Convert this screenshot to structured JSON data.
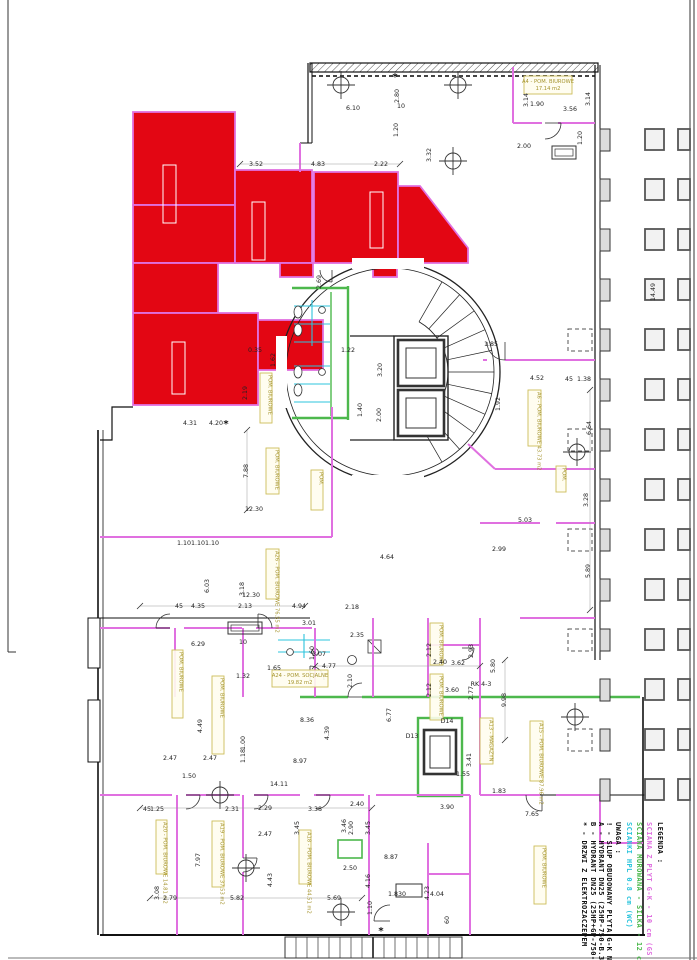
{
  "legend": {
    "title": "LEGENDA :",
    "items": [
      {
        "color": "#e070e0",
        "label": "SCIANA Z PLYT G-K - 10 cm (GS 100)"
      },
      {
        "color": "#4db84d",
        "label": "SCIANA MUROWANA - SILKA - 12 cm"
      },
      {
        "color": "#2cc4dc",
        "label": "SCIANKI HPL 0.8 cm (WC)"
      }
    ]
  },
  "notes": {
    "title": "UWAGA :",
    "items": [
      "! - SLUP OBUDOWANY PLYTA G-K NA STEL.",
      "A - HYDRANT DN25 (25HP-750-B.30: 25 X",
      "B - HYDRANT DN25 (25HP+GP-750-B.30 ) 2",
      "* - DRZWI Z ELEKTROZACZEPEM"
    ]
  },
  "rooms": [
    {
      "l": "A4 - POM. BIUROWE",
      "a": "17.14 m2",
      "x": 524,
      "y": 76,
      "w": 48,
      "h": 18,
      "v": 0
    },
    {
      "l": "A24 - POM. SOCJALNE",
      "a": "19.82 m2",
      "x": 272,
      "y": 670,
      "w": 56,
      "h": 17,
      "v": 0
    },
    {
      "l": "A6 - POM. BIUROWE",
      "a": "43.73 m2",
      "x": 528,
      "y": 390,
      "w": 13,
      "h": 56,
      "v": 1
    },
    {
      "l": "A26 - POM. BIUROWE",
      "a": "76.55 m2",
      "x": 266,
      "y": 549,
      "w": 13,
      "h": 50,
      "v": 1
    },
    {
      "l": "POM. BIUROWE",
      "a": "",
      "x": 172,
      "y": 650,
      "w": 11,
      "h": 68,
      "v": 1
    },
    {
      "l": "POM. BIUROWE",
      "a": "",
      "x": 212,
      "y": 676,
      "w": 12,
      "h": 78,
      "v": 1
    },
    {
      "l": "A19 - POM. BIUROWE",
      "a": "37.53 m2",
      "x": 212,
      "y": 821,
      "w": 12,
      "h": 66,
      "v": 1
    },
    {
      "l": "A20 - POM. BIUROWE",
      "a": "14.81 m2",
      "x": 156,
      "y": 820,
      "w": 11,
      "h": 54,
      "v": 1
    },
    {
      "l": "A18 - POM. BIUROWE",
      "a": "44.51 m2",
      "x": 299,
      "y": 830,
      "w": 12,
      "h": 54,
      "v": 1
    },
    {
      "l": "POM. BIUROWE",
      "a": "",
      "x": 534,
      "y": 846,
      "w": 12,
      "h": 58,
      "v": 1
    },
    {
      "l": "A15 - POM. BIUROWE",
      "a": "87.96 m2",
      "x": 530,
      "y": 721,
      "w": 13,
      "h": 60,
      "v": 1
    },
    {
      "l": "A13 - MAGAZYN",
      "a": "",
      "x": 480,
      "y": 718,
      "w": 13,
      "h": 46,
      "v": 1
    },
    {
      "l": "POM. BIUROWE",
      "a": "",
      "x": 430,
      "y": 623,
      "w": 13,
      "h": 42,
      "v": 1
    },
    {
      "l": "POM. BIUROWE",
      "a": "",
      "x": 430,
      "y": 674,
      "w": 13,
      "h": 46,
      "v": 1
    },
    {
      "l": "POM. BIUROWE",
      "a": "",
      "x": 266,
      "y": 448,
      "w": 13,
      "h": 46,
      "v": 1
    },
    {
      "l": "POM.",
      "a": "",
      "x": 311,
      "y": 470,
      "w": 12,
      "h": 40,
      "v": 1
    },
    {
      "l": "POM. BIUROWE",
      "a": "",
      "x": 260,
      "y": 373,
      "w": 12,
      "h": 50,
      "v": 1
    },
    {
      "l": "POM.",
      "a": "",
      "x": 556,
      "y": 466,
      "w": 10,
      "h": 26,
      "v": 1
    }
  ],
  "dimensions": [
    [
      "3.52",
      256,
      166,
      0
    ],
    [
      "4.83",
      318,
      166,
      0
    ],
    [
      "2.22",
      381,
      166,
      0
    ],
    [
      "6.10",
      353,
      110,
      0
    ],
    [
      "2.80",
      399,
      96,
      1
    ],
    [
      "1.20",
      398,
      130,
      1
    ],
    [
      "3.32",
      431,
      155,
      1
    ],
    [
      "1.90",
      537,
      106,
      0
    ],
    [
      "3.56",
      570,
      111,
      0
    ],
    [
      "3.14",
      528,
      100,
      1
    ],
    [
      "3.14",
      590,
      99,
      1
    ],
    [
      "2.00",
      524,
      148,
      0
    ],
    [
      "1.20",
      582,
      138,
      1
    ],
    [
      "14.49",
      655,
      292,
      1
    ],
    [
      "6.64",
      591,
      428,
      1
    ],
    [
      "3.28",
      588,
      500,
      1
    ],
    [
      "5.89",
      590,
      571,
      1
    ],
    [
      "4.52",
      537,
      380,
      0
    ],
    [
      "45",
      569,
      381,
      0
    ],
    [
      "1.38",
      584,
      381,
      0
    ],
    [
      "1.85",
      491,
      346,
      0
    ],
    [
      "1.92",
      500,
      404,
      1
    ],
    [
      "7.88",
      248,
      471,
      1
    ],
    [
      "12.30",
      254,
      511,
      0
    ],
    [
      "12.30",
      251,
      597,
      0
    ],
    [
      "6.03",
      209,
      586,
      1
    ],
    [
      "3.18",
      244,
      589,
      1
    ],
    [
      "45",
      179,
      608,
      0
    ],
    [
      "4.35",
      198,
      608,
      0
    ],
    [
      "2.13",
      245,
      608,
      0
    ],
    [
      "4.94",
      299,
      608,
      0
    ],
    [
      "1.10",
      184,
      545,
      0
    ],
    [
      "1.10",
      198,
      545,
      0
    ],
    [
      "1.10",
      212,
      545,
      0
    ],
    [
      "4.31",
      190,
      425,
      0
    ],
    [
      "4.20",
      216,
      425,
      0
    ],
    [
      "2.19",
      247,
      393,
      1
    ],
    [
      "1.62",
      275,
      360,
      1
    ],
    [
      "0.35",
      255,
      352,
      0
    ],
    [
      "2.69",
      321,
      282,
      1
    ],
    [
      "1.22",
      348,
      352,
      0
    ],
    [
      "3.20",
      382,
      370,
      1
    ],
    [
      "2.00",
      381,
      415,
      1
    ],
    [
      "1.40",
      362,
      410,
      1
    ],
    [
      "6.29",
      198,
      646,
      0
    ],
    [
      "1.32",
      243,
      678,
      0
    ],
    [
      "1.65",
      274,
      670,
      0
    ],
    [
      "4.77",
      329,
      668,
      0
    ],
    [
      "2.35",
      357,
      637,
      0
    ],
    [
      "2.10",
      352,
      681,
      1
    ],
    [
      "8.36",
      307,
      722,
      0
    ],
    [
      "4.39",
      329,
      733,
      1
    ],
    [
      "8.97",
      300,
      763,
      0
    ],
    [
      "14.11",
      279,
      786,
      0
    ],
    [
      "2.47",
      170,
      760,
      0
    ],
    [
      "2.47",
      210,
      760,
      0
    ],
    [
      "1.50",
      189,
      778,
      0
    ],
    [
      "4.49",
      202,
      726,
      1
    ],
    [
      "1.00",
      245,
      743,
      1
    ],
    [
      "1.18",
      245,
      756,
      1
    ],
    [
      "3.01",
      309,
      625,
      0
    ],
    [
      "1.60",
      314,
      653,
      1
    ],
    [
      "3.07",
      319,
      656,
      0
    ],
    [
      "6.77",
      391,
      715,
      1
    ],
    [
      "2.12",
      431,
      650,
      1
    ],
    [
      "2.93",
      473,
      651,
      1
    ],
    [
      "3.62",
      458,
      665,
      0
    ],
    [
      "5.80",
      495,
      666,
      1
    ],
    [
      "9.98",
      506,
      700,
      1
    ],
    [
      "2.12",
      431,
      690,
      1
    ],
    [
      "2.77",
      473,
      693,
      1
    ],
    [
      "2.40",
      440,
      664,
      0
    ],
    [
      "3.60",
      452,
      692,
      0
    ],
    [
      "2.18",
      352,
      609,
      0
    ],
    [
      "3.41",
      471,
      760,
      1
    ],
    [
      "1.55",
      463,
      776,
      0
    ],
    [
      "45",
      147,
      811,
      0
    ],
    [
      "1.25",
      157,
      811,
      0
    ],
    [
      "2.31",
      232,
      811,
      0
    ],
    [
      "2.29",
      265,
      810,
      0
    ],
    [
      "3.38",
      315,
      811,
      0
    ],
    [
      "2.40",
      357,
      806,
      0
    ],
    [
      "2.90",
      353,
      828,
      1
    ],
    [
      "3.45",
      299,
      828,
      1
    ],
    [
      "3.45",
      370,
      828,
      1
    ],
    [
      "3.46",
      346,
      826,
      1
    ],
    [
      "2.50",
      350,
      870,
      0
    ],
    [
      "4.16",
      370,
      881,
      1
    ],
    [
      "5.82",
      237,
      900,
      0
    ],
    [
      "5.69",
      334,
      900,
      0
    ],
    [
      "2.79",
      170,
      900,
      0
    ],
    [
      "3.08",
      159,
      893,
      1
    ],
    [
      "7.97",
      200,
      860,
      1
    ],
    [
      "4.43",
      272,
      880,
      1
    ],
    [
      "2.47",
      265,
      836,
      0
    ],
    [
      "1.10",
      372,
      908,
      1
    ],
    [
      "1.830",
      397,
      896,
      0
    ],
    [
      "4.23",
      429,
      893,
      1
    ],
    [
      "4.04",
      437,
      896,
      0
    ],
    [
      "60",
      449,
      920,
      1
    ],
    [
      "7.65",
      532,
      816,
      0
    ],
    [
      "3.90",
      447,
      809,
      0
    ],
    [
      "8.87",
      391,
      859,
      0
    ],
    [
      "4.64",
      387,
      559,
      0
    ],
    [
      "2.99",
      499,
      551,
      0
    ],
    [
      "5.03",
      525,
      522,
      0
    ],
    [
      "1.83",
      499,
      793,
      0
    ],
    [
      "D13",
      412,
      738,
      0
    ],
    [
      "D14",
      447,
      723,
      0
    ],
    [
      "RK 4-3",
      481,
      686,
      0
    ],
    [
      "10",
      401,
      108,
      0
    ],
    [
      "10",
      243,
      644,
      0
    ]
  ],
  "symbols": [
    {
      "g": "*",
      "x": 226,
      "y": 427
    },
    {
      "g": "*",
      "x": 381,
      "y": 934
    },
    {
      "g": "*",
      "x": 395,
      "y": 80
    }
  ]
}
